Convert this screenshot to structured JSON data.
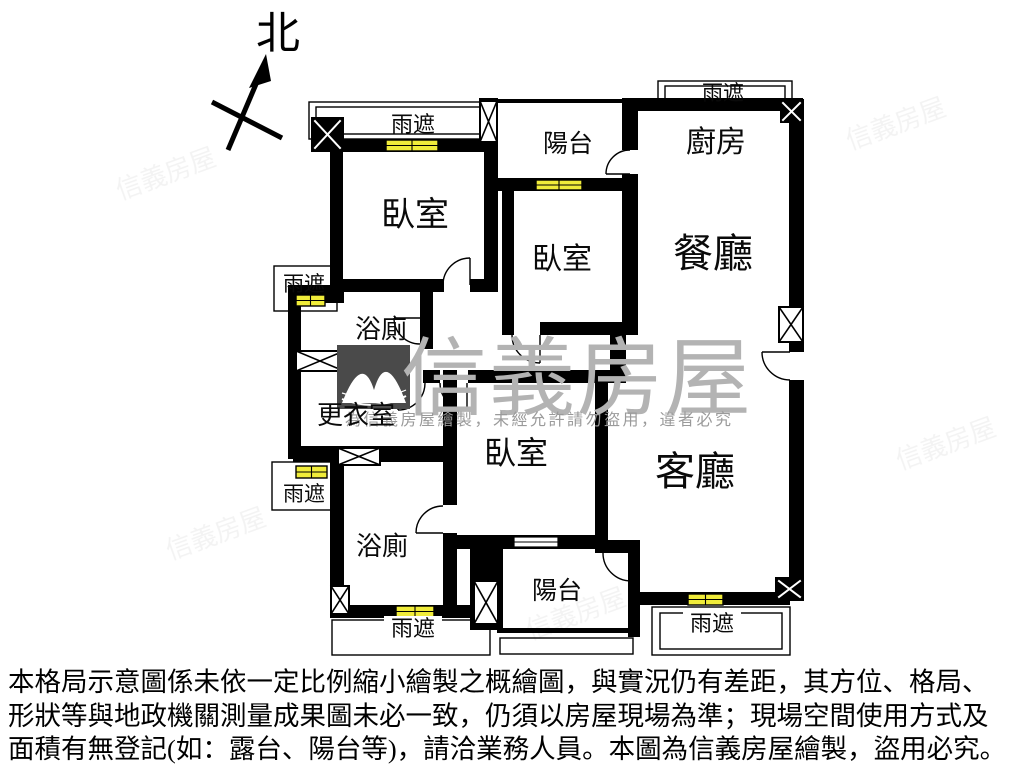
{
  "compass": {
    "north_label": "北"
  },
  "rooms": {
    "bedroom": "臥室",
    "balcony": "陽台",
    "kitchen": "廚房",
    "dining": "餐廳",
    "living": "客廳",
    "bathroom": "浴廁",
    "dressing_room": "更衣室",
    "rain_awning": "雨遮"
  },
  "watermark": {
    "brand": "信義房屋",
    "notice": "為信義房屋繪製，未經允許請勿盜用，違者必究"
  },
  "disclaimer": {
    "line1": "本格局示意圖係未依一定比例縮小繪製之概繪圖，與實況仍有差距，其方位、格局、",
    "line2": "形狀等與地政機關測量成果圖未必一致，仍須以房屋現場為準；現場空間使用方式及",
    "line3": "面積有無登記(如：露台、陽台等)，請洽業務人員。本圖為信義房屋繪製，盜用必究。"
  },
  "colors": {
    "wall": "#000000",
    "window_fill": "#f0ec3a",
    "watermark_gray": "#b3b3b3",
    "logo_gray": "#4a4a4a"
  }
}
